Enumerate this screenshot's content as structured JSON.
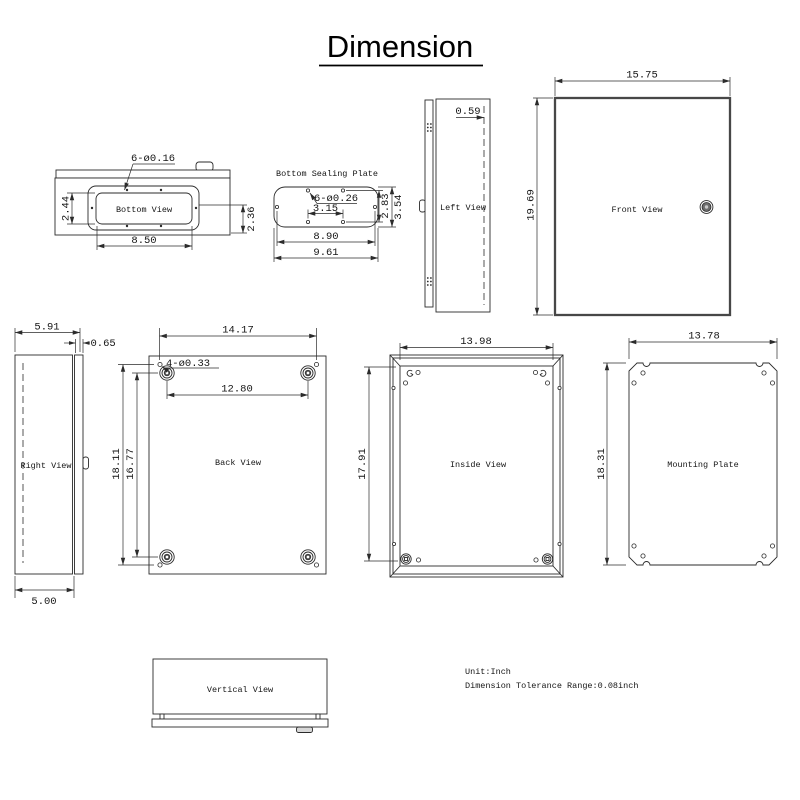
{
  "title": "Dimension",
  "colors": {
    "line": "#2b2b2b",
    "background": "#ffffff"
  },
  "notes": {
    "unit": "Unit:Inch",
    "tolerance": "Dimension Tolerance Range:0.08inch"
  },
  "views": {
    "bottom_view": {
      "label": "Bottom View",
      "hole_callout": "6-ø0.16",
      "cutout_height": "2.44",
      "edge_offset": "2.36",
      "cutout_width": "8.50"
    },
    "bottom_sealing_plate": {
      "label": "Bottom Sealing Plate",
      "hole_callout": "6-ø0.26",
      "hole_pitch": "3.15",
      "hole_rows": "2.83",
      "plate_height": "3.54",
      "hole_span": "8.90",
      "plate_width": "9.61"
    },
    "left_view": {
      "label": "Left View",
      "door_depth": "0.59"
    },
    "front_view": {
      "label": "Front View",
      "width": "15.75",
      "height": "19.69"
    },
    "right_view": {
      "label": "Right View",
      "depth": "5.91",
      "flange": "0.65",
      "body_depth": "5.00"
    },
    "back_view": {
      "label": "Back View",
      "width": "14.17",
      "boss_span": "12.80",
      "hole_callout": "4-ø0.33",
      "height": "18.11",
      "boss_height": "16.77"
    },
    "inside_view": {
      "label": "Inside View",
      "width": "13.98",
      "height": "17.91"
    },
    "mounting_plate": {
      "label": "Mounting Plate",
      "width": "13.78",
      "height": "18.31"
    },
    "vertical_view": {
      "label": "Vertical View"
    }
  }
}
